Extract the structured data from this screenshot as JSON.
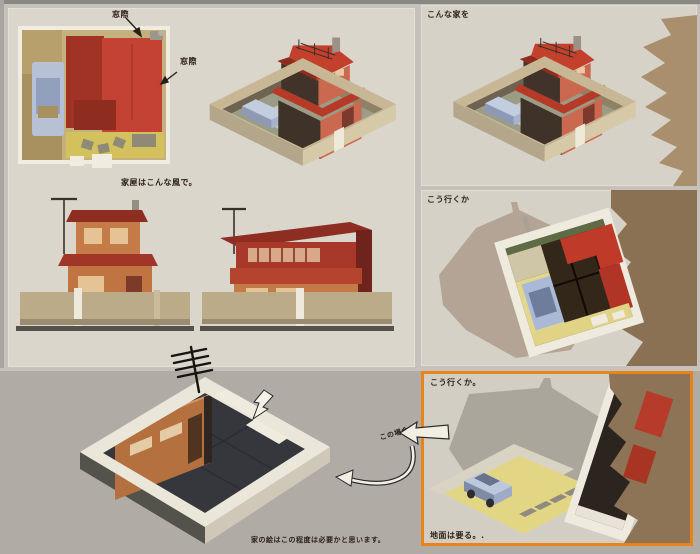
{
  "page": {
    "bg_bottom": "#b0aca5",
    "bg_top": "#c6c2bb",
    "accent_orange": "#e8831c"
  },
  "overview_panel": {
    "caption": "家屋はこんな風で。",
    "plan": {
      "label_top": "窓際",
      "label_right": "窓際"
    }
  },
  "panel_top_right": {
    "label": "こんな家を"
  },
  "panel_middle_right": {
    "label": "こう行くか"
  },
  "panel_bottom_right": {
    "label": "こう行くか。",
    "ground_note": "地面は要る。."
  },
  "workspace": {
    "case_label": "この場合",
    "caption": "家の絵はこの程度は必要かと思います。"
  },
  "colors": {
    "roof_red_bright": "#c2402c",
    "roof_red_dark": "#8e2e22",
    "wall_salmon": "#cb6950",
    "wall_dark_brown": "#3f3228",
    "wall_orange": "#c47a46",
    "fence_tan": "#c3b292",
    "car_blue": "#b7c1d6",
    "yard_yellow": "#d2c15c",
    "torn_paper_tan": "#8d7456",
    "silhouette_gray": "#aaa69c",
    "plan_beige": "#c4b17e",
    "box_white": "#ebe6da",
    "box_floor_dark": "#35373c",
    "ink": "#2e2117"
  }
}
